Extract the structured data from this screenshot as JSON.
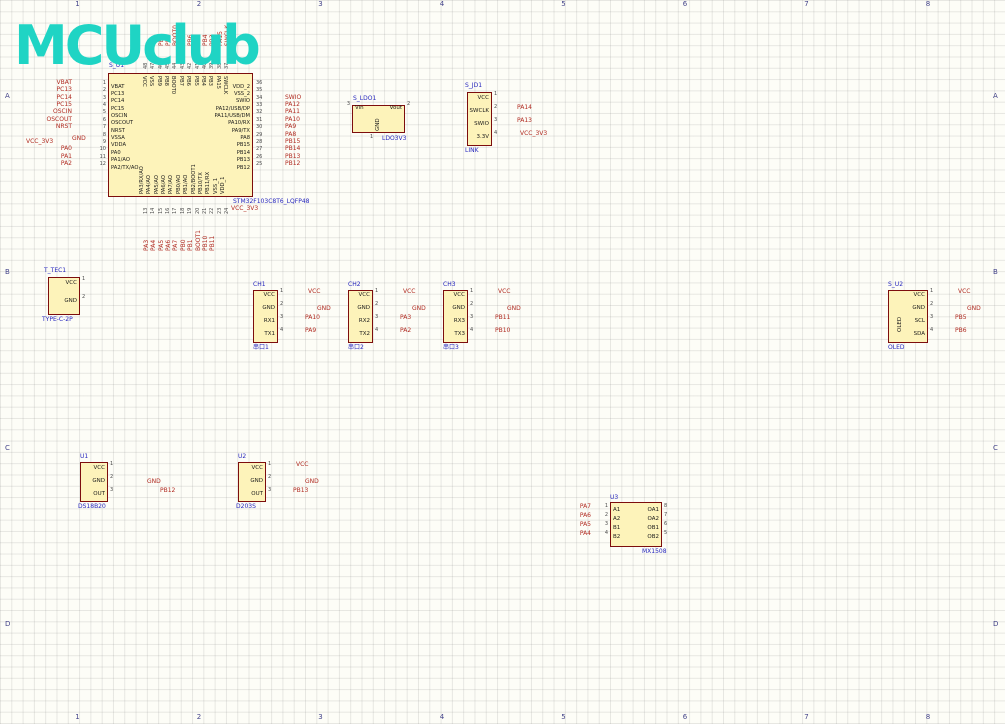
{
  "sheet": {
    "logo": "MCUclub",
    "cols": [
      "1",
      "2",
      "3",
      "4",
      "5",
      "6",
      "7",
      "8"
    ],
    "rows": [
      "A",
      "B",
      "C",
      "D"
    ]
  },
  "colors": {
    "wire": "#1616ae",
    "component_fill": "#fdf3ba",
    "component_border": "#7d0d0d",
    "net_label": "#b02a20",
    "value_label": "#2626bd",
    "title": "#3737c8",
    "gnd_symbol": "#8b2015",
    "vcc_symbol": "#c02818",
    "logo": "#1fd4c4"
  },
  "mcu": {
    "designator": "S_U1",
    "part": "STM32F103C8T6_LQFP48",
    "left": [
      {
        "num": "1",
        "name": "VBAT",
        "net": "VBAT"
      },
      {
        "num": "2",
        "name": "PC13",
        "net": "PC13"
      },
      {
        "num": "3",
        "name": "PC14",
        "net": "PC14"
      },
      {
        "num": "4",
        "name": "PC15",
        "net": "PC15"
      },
      {
        "num": "5",
        "name": "OSCIN",
        "net": "OSCIN"
      },
      {
        "num": "6",
        "name": "OSCOUT",
        "net": "OSCOUT"
      },
      {
        "num": "7",
        "name": "NRST",
        "net": "NRST"
      },
      {
        "num": "8",
        "name": "VSSA",
        "net": "GND",
        "power": "gnd"
      },
      {
        "num": "9",
        "name": "VDDA",
        "net": "VCC_3V3",
        "power": "vcc"
      },
      {
        "num": "10",
        "name": "PA0",
        "net": "PA0"
      },
      {
        "num": "11",
        "name": "PA1/AO",
        "net": "PA1"
      },
      {
        "num": "12",
        "name": "PA2/TX/AO",
        "net": "PA2"
      }
    ],
    "right": [
      {
        "num": "36",
        "name": "VDD_2",
        "net": "VCC_3V3",
        "power": "vcc"
      },
      {
        "num": "35",
        "name": "VSS_2",
        "net": "GND",
        "power": "gnd"
      },
      {
        "num": "34",
        "name": "SWIO",
        "net": "SWIO"
      },
      {
        "num": "33",
        "name": "PA12/USB/DP",
        "net": "PA12"
      },
      {
        "num": "32",
        "name": "PA11/USB/DM",
        "net": "PA11"
      },
      {
        "num": "31",
        "name": "PA10/RX",
        "net": "PA10"
      },
      {
        "num": "30",
        "name": "PA9/TX",
        "net": "PA9"
      },
      {
        "num": "29",
        "name": "PA8",
        "net": "PA8"
      },
      {
        "num": "28",
        "name": "PB15",
        "net": "PB15"
      },
      {
        "num": "27",
        "name": "PB14",
        "net": "PB14"
      },
      {
        "num": "26",
        "name": "PB13",
        "net": "PB13"
      },
      {
        "num": "25",
        "name": "PB12",
        "net": "PB12"
      }
    ],
    "top": [
      {
        "num": "48",
        "name": "VCC",
        "net": "VCC",
        "power": "vcc"
      },
      {
        "num": "47",
        "name": "VSS",
        "net": "GND",
        "power": "gnd"
      },
      {
        "num": "46",
        "name": "PB9",
        "net": "PB9"
      },
      {
        "num": "45",
        "name": "PB8",
        "net": "PB8"
      },
      {
        "num": "44",
        "name": "BOOT0",
        "net": "BOOT0"
      },
      {
        "num": "43",
        "name": "PB7",
        "net": "PB7"
      },
      {
        "num": "42",
        "name": "PB6",
        "net": "PB6"
      },
      {
        "num": "41",
        "name": "PB5",
        "net": "PB5"
      },
      {
        "num": "40",
        "name": "PB4",
        "net": "PB4"
      },
      {
        "num": "39",
        "name": "PB3",
        "net": "PB3"
      },
      {
        "num": "38",
        "name": "PA15",
        "net": "PA15"
      },
      {
        "num": "37",
        "name": "SWCLK",
        "net": "SWCLK"
      }
    ],
    "bottom": [
      {
        "num": "13",
        "name": "PA3/RX/AO",
        "net": "PA3"
      },
      {
        "num": "14",
        "name": "PA4/AO",
        "net": "PA4"
      },
      {
        "num": "15",
        "name": "PA5/AO",
        "net": "PA5"
      },
      {
        "num": "16",
        "name": "PA6/AO",
        "net": "PA6"
      },
      {
        "num": "17",
        "name": "PA7/AO",
        "net": "PA7"
      },
      {
        "num": "18",
        "name": "PB0/AO",
        "net": "PB0"
      },
      {
        "num": "19",
        "name": "PB1/AO",
        "net": "PB1"
      },
      {
        "num": "20",
        "name": "PB2/BOOT1",
        "net": "BOOT1"
      },
      {
        "num": "21",
        "name": "PB10/TX",
        "net": "PB10"
      },
      {
        "num": "22",
        "name": "PB11/RX",
        "net": "PB11"
      },
      {
        "num": "23",
        "name": "VSS_1",
        "net": "GND",
        "power": "gnd"
      },
      {
        "num": "24",
        "name": "VDD_1",
        "net": "VCC_3V3",
        "power": "vcc"
      }
    ]
  },
  "modules": [
    {
      "id": "ldo",
      "designator": "S_LDO1",
      "part": "LDO3V3",
      "vtext": "GND",
      "pins": {
        "left": [
          {
            "num": "3",
            "name": "Vin"
          }
        ],
        "right": [
          {
            "num": "2",
            "name": "Vout"
          }
        ],
        "bottom": [
          {
            "num": "1",
            "name": ""
          }
        ]
      }
    },
    {
      "id": "jlink",
      "designator": "S_JD1",
      "part": "LINK",
      "pins": {
        "right": [
          {
            "num": "1",
            "name": "VCC"
          },
          {
            "num": "2",
            "name": "SWCLK",
            "net": "PA14"
          },
          {
            "num": "3",
            "name": "SWIO",
            "net": "PA13"
          },
          {
            "num": "4",
            "name": "3.3V",
            "net": "VCC_3V3",
            "power": "vcc"
          }
        ]
      }
    },
    {
      "id": "tec1",
      "designator": "T_TEC1",
      "part": "TYPE-C-2P",
      "pins": {
        "right": [
          {
            "num": "1",
            "name": "VCC"
          },
          {
            "num": "2",
            "name": "GND"
          }
        ]
      }
    },
    {
      "id": "ch1",
      "designator": "CH1",
      "part": "串口1",
      "pins": {
        "right": [
          {
            "num": "1",
            "name": "VCC",
            "net": "VCC",
            "power": "vcc"
          },
          {
            "num": "2",
            "name": "GND",
            "net": "GND",
            "power": "gnd"
          },
          {
            "num": "3",
            "name": "RX1",
            "net": "PA10"
          },
          {
            "num": "4",
            "name": "TX1",
            "net": "PA9"
          }
        ]
      }
    },
    {
      "id": "ch2",
      "designator": "CH2",
      "part": "串口2",
      "pins": {
        "right": [
          {
            "num": "1",
            "name": "VCC",
            "net": "VCC",
            "power": "vcc"
          },
          {
            "num": "2",
            "name": "GND",
            "net": "GND",
            "power": "gnd"
          },
          {
            "num": "3",
            "name": "RX2",
            "net": "PA3"
          },
          {
            "num": "4",
            "name": "TX2",
            "net": "PA2"
          }
        ]
      }
    },
    {
      "id": "ch3",
      "designator": "CH3",
      "part": "串口3",
      "pins": {
        "right": [
          {
            "num": "1",
            "name": "VCC",
            "net": "VCC",
            "power": "vcc"
          },
          {
            "num": "2",
            "name": "GND",
            "net": "GND",
            "power": "gnd"
          },
          {
            "num": "3",
            "name": "RX3",
            "net": "PB11"
          },
          {
            "num": "4",
            "name": "TX3",
            "net": "PB10"
          }
        ]
      }
    },
    {
      "id": "oled",
      "designator": "S_U2",
      "part": "OLED",
      "vtext": "OLED",
      "pins": {
        "right": [
          {
            "num": "1",
            "name": "VCC",
            "net": "VCC",
            "power": "vcc"
          },
          {
            "num": "2",
            "name": "GND",
            "net": "GND",
            "power": "gnd"
          },
          {
            "num": "3",
            "name": "SCL",
            "net": "PB5"
          },
          {
            "num": "4",
            "name": "SDA",
            "net": "PB6"
          }
        ]
      }
    },
    {
      "id": "temp",
      "designator": "U1",
      "part": "DS18B20",
      "pins": {
        "right": [
          {
            "num": "1",
            "name": "VCC"
          },
          {
            "num": "2",
            "name": "GND",
            "net": "GND",
            "power": "gnd"
          },
          {
            "num": "3",
            "name": "OUT",
            "net": "PB12"
          }
        ]
      }
    },
    {
      "id": "pir",
      "designator": "U2",
      "part": "D203S",
      "pins": {
        "right": [
          {
            "num": "1",
            "name": "VCC",
            "net": "VCC",
            "power": "vcc"
          },
          {
            "num": "2",
            "name": "GND",
            "net": "GND",
            "power": "gnd"
          },
          {
            "num": "3",
            "name": "OUT",
            "net": "PB13"
          }
        ]
      }
    },
    {
      "id": "motor",
      "designator": "U3",
      "part": "MX1508",
      "pins": {
        "left": [
          {
            "num": "1",
            "name": "A1",
            "net": "PA7"
          },
          {
            "num": "2",
            "name": "A2",
            "net": "PA6"
          },
          {
            "num": "3",
            "name": "B1",
            "net": "PA5"
          },
          {
            "num": "4",
            "name": "B2",
            "net": "PA4"
          }
        ],
        "right": [
          {
            "num": "8",
            "name": "OA1"
          },
          {
            "num": "7",
            "name": "OA2"
          },
          {
            "num": "6",
            "name": "OB1"
          },
          {
            "num": "5",
            "name": "OB2"
          }
        ],
        "top": [
          {
            "num": "9",
            "name": "VCC"
          }
        ],
        "bottom": [
          {
            "num": "10",
            "name": "GND"
          }
        ]
      }
    },
    {
      "id": "jd1",
      "designator": "JD1",
      "vtext": "2PIN",
      "pins": {}
    },
    {
      "id": "jd2",
      "designator": "JD2",
      "vtext": "2PIN",
      "pins": {}
    },
    {
      "id": "ultra",
      "designator": "U4",
      "part": "HC-R04",
      "pins": {
        "right": [
          {
            "num": "1",
            "name": "VCC",
            "net": "VCC",
            "power": "vcc"
          },
          {
            "num": "2",
            "name": "TRIG",
            "net": "PB15"
          },
          {
            "num": "3",
            "name": "ECHO",
            "net": "PB14"
          },
          {
            "num": "4",
            "name": "GND",
            "net": "GND",
            "power": "gnd"
          }
        ]
      }
    },
    {
      "id": "pm25",
      "designator": "U5",
      "part": "GP2Y1014AU",
      "pins": {
        "right": [
          {
            "num": "1",
            "name": "L-VCC"
          },
          {
            "num": "2",
            "name": "L-GND"
          },
          {
            "num": "3",
            "name": "LED",
            "net": "PA1"
          },
          {
            "num": "4",
            "name": "S-GND"
          },
          {
            "num": "5",
            "name": "OUT",
            "net": "PA0"
          },
          {
            "num": "6",
            "name": "VCC"
          }
        ]
      }
    },
    {
      "id": "bt",
      "designator": "U6",
      "part": "Bluetooth",
      "vtext": "Bluetooth",
      "pins": {
        "right": [
          {
            "num": "1",
            "name": "VCC",
            "net": "VCC",
            "power": "vcc"
          },
          {
            "num": "2",
            "name": "GND",
            "net": "GND",
            "power": "gnd"
          },
          {
            "num": "3",
            "name": "TXD",
            "net": "PA10"
          },
          {
            "num": "4",
            "name": "RXD",
            "net": "PA9"
          }
        ]
      }
    }
  ],
  "parts": [
    {
      "id": "s_c3",
      "ref": "S_C3",
      "value": "0.1uF"
    },
    {
      "id": "s_c4",
      "ref": "S_C4",
      "value": "0.1uF"
    },
    {
      "id": "s_r1",
      "ref": "S_R1",
      "value": "10K"
    },
    {
      "id": "s_ec1",
      "ref": "S_EC1",
      "value": "1uF"
    },
    {
      "id": "s_k1",
      "ref": "S_K1",
      "value": "KEY"
    },
    {
      "id": "s_c1",
      "ref": "S_C1",
      "value": "20pF"
    },
    {
      "id": "s_c5",
      "ref": "S_C5",
      "value": "20pF"
    },
    {
      "id": "s_y1",
      "ref": "S_Y1",
      "value": "8M"
    },
    {
      "id": "r1x",
      "ref": "R1",
      "value": "RES"
    },
    {
      "id": "s_c2",
      "ref": "S_C2",
      "value": "20pF"
    },
    {
      "id": "s_c6",
      "ref": "S_C6",
      "value": "20pF"
    },
    {
      "id": "s_y2",
      "ref": "S_Y2",
      "value": "8M"
    },
    {
      "id": "t_s1",
      "ref": "T_S1",
      "value": "S_KFT DIP-8X8"
    },
    {
      "id": "t_ec1",
      "ref": "T_EC1",
      "value": "220uF"
    },
    {
      "id": "t_r1",
      "ref": "T_R1",
      "value": "1K"
    },
    {
      "id": "t_d1",
      "ref": "T_D1",
      "value": "LED"
    },
    {
      "id": "k1",
      "ref": "K1",
      "value": "KEY"
    },
    {
      "id": "k2",
      "ref": "K2",
      "value": "KEY"
    },
    {
      "id": "k3",
      "ref": "K3",
      "value": "KEY"
    },
    {
      "id": "k4",
      "ref": "K4",
      "value": "KEY"
    },
    {
      "id": "l_r1",
      "ref": "L_R1",
      "value": "1K"
    },
    {
      "id": "l_d1",
      "ref": "L_D1",
      "value": "LED"
    },
    {
      "id": "b_r1",
      "ref": "B_R1",
      "value": "1K"
    },
    {
      "id": "b_b1",
      "ref": "B_B1",
      "value": "BEEP"
    },
    {
      "id": "b_q1",
      "ref": "B_Q1",
      "value": "S9013"
    },
    {
      "id": "r2",
      "ref": "R2",
      "value": "10K"
    },
    {
      "id": "c1p",
      "ref": "C1",
      "value": "220uF"
    },
    {
      "id": "r3",
      "ref": "R3",
      "value": "150"
    }
  ],
  "net_labels": [
    {
      "id": "nrst",
      "text": "NRST"
    },
    {
      "id": "oscin1",
      "text": "OSCIN"
    },
    {
      "id": "oscout1",
      "text": "OSCOUT"
    },
    {
      "id": "oscin2",
      "text": "OSCIN"
    },
    {
      "id": "oscout2",
      "text": "OSCOUT"
    },
    {
      "id": "pb7",
      "text": "PB7"
    },
    {
      "id": "pb8",
      "text": "PB8"
    },
    {
      "id": "pb9",
      "text": "PB9"
    },
    {
      "id": "pa11",
      "text": "PA11"
    },
    {
      "id": "pb0",
      "text": "PB0"
    },
    {
      "id": "pb1",
      "text": "PB1"
    },
    {
      "id": "b",
      "text": "B"
    }
  ],
  "power": [
    {
      "id": "mcu_t_gnd",
      "label": "GND"
    },
    {
      "id": "mcu_t_vcc",
      "label": "VCC"
    },
    {
      "id": "mcu_tr_v33",
      "label": "VCC_3V3"
    },
    {
      "id": "mcu_tr_gnd",
      "label": "GND"
    },
    {
      "id": "mcu_l_gnd",
      "label": "GND"
    },
    {
      "id": "mcu_l_v33",
      "label": "VCC_3V3"
    },
    {
      "id": "mcu_b_v33",
      "label": "VCC_3V3"
    },
    {
      "id": "mcu_b_gnd",
      "label": ""
    },
    {
      "id": "ldo_vcc",
      "label": "VCC"
    },
    {
      "id": "ldo_v33",
      "label": "VCC_3V3"
    },
    {
      "id": "ldo_gnd",
      "label": "GND"
    },
    {
      "id": "jl_gnd",
      "label": "GND"
    },
    {
      "id": "rst_v33",
      "label": "VCC_3V3"
    },
    {
      "id": "rst_gnd",
      "label": "GND"
    },
    {
      "id": "x1_gnda",
      "label": "GND"
    },
    {
      "id": "x1_gndb",
      "label": "GND"
    },
    {
      "id": "x2_gnda",
      "label": "GND"
    },
    {
      "id": "x2_gndb",
      "label": "GND"
    },
    {
      "id": "pw_vcc",
      "label": "VCC"
    },
    {
      "id": "pw_gnd",
      "label": "GND"
    },
    {
      "id": "key_gnd",
      "label": "GND"
    },
    {
      "id": "led_v33",
      "label": "VCC_3V3"
    },
    {
      "id": "buz_vcc",
      "label": "VCC"
    },
    {
      "id": "buz_gnd",
      "label": "GND"
    },
    {
      "id": "mot_vcc",
      "label": "VCC"
    },
    {
      "id": "mot_gnd",
      "label": "GND"
    },
    {
      "id": "temp_vcc",
      "label": "VCC"
    },
    {
      "id": "pm_gnd1",
      "label": "GND"
    },
    {
      "id": "pm_vcc1",
      "label": "VCC"
    },
    {
      "id": "pm_gnd2",
      "label": "GND"
    },
    {
      "id": "pm_vcc2",
      "label": "VCC"
    }
  ],
  "titles": [
    {
      "id": "t_ldo",
      "text": "5V转3.3V电路"
    },
    {
      "id": "t_jlink",
      "text": "J-Link OB接口"
    },
    {
      "id": "t_reset",
      "text": "复位电路"
    },
    {
      "id": "t_xtal",
      "text": "晶振电路"
    },
    {
      "id": "t_power",
      "text": "电源电路"
    },
    {
      "id": "t_uart",
      "text": "串口电路"
    },
    {
      "id": "t_key",
      "text": "按键电路"
    },
    {
      "id": "t_led",
      "text": "LED灯电路"
    },
    {
      "id": "t_buzz",
      "text": "蜂鸣器电路"
    },
    {
      "id": "t_oled",
      "text": "OLED显示屏"
    },
    {
      "id": "t_temp",
      "text": "温度检测模块"
    },
    {
      "id": "t_pir",
      "text": "人体热释电感应模块"
    },
    {
      "id": "t_motor",
      "text": "直流电机电路"
    },
    {
      "id": "t_ultra",
      "text": "超声波测距模块"
    },
    {
      "id": "t_pm25",
      "text": "PM2.5检测模块"
    },
    {
      "id": "t_bt",
      "text": "蓝牙模块"
    }
  ],
  "switch_pins": [
    "1",
    "2",
    "7",
    "4",
    "3",
    "6",
    "5"
  ]
}
